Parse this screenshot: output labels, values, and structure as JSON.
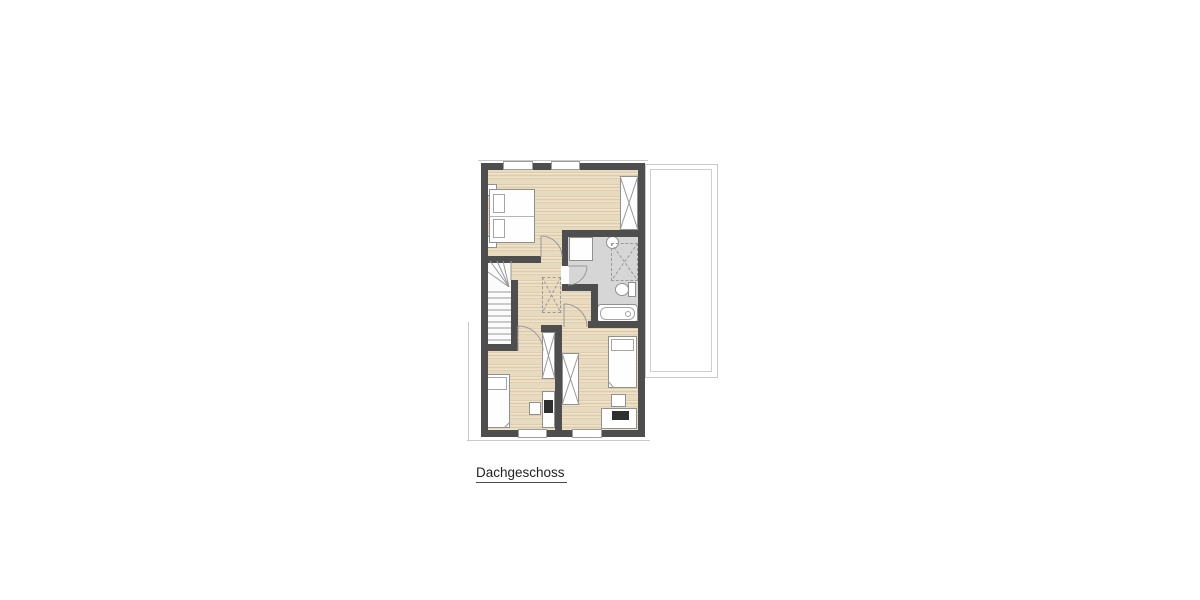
{
  "floor_plan": {
    "label": "Dachgeschoss",
    "colors": {
      "wall": "#4e4e4e",
      "wood_floor": "#e8dabd",
      "bathroom_floor": "#d6d6d6",
      "furniture_outline": "#9a9a9a",
      "roof_edge_line": "#c9c9c9",
      "background": "#ffffff"
    },
    "semantic_areas": [
      "bedroom-top",
      "bathroom",
      "hallway",
      "staircase",
      "room-bottom-left",
      "room-bottom-right",
      "balcony"
    ],
    "fixtures": [
      "double-bed",
      "single-bed-left",
      "single-bed-right",
      "wardrobe-bedroom",
      "wardrobe-left-room",
      "wardrobe-right-room",
      "vanity",
      "washbasin",
      "shower",
      "toilet",
      "bathtub",
      "desk-left",
      "desk-right",
      "chair-left",
      "chair-right",
      "ceiling-void",
      "stairs",
      "doors",
      "windows"
    ]
  }
}
